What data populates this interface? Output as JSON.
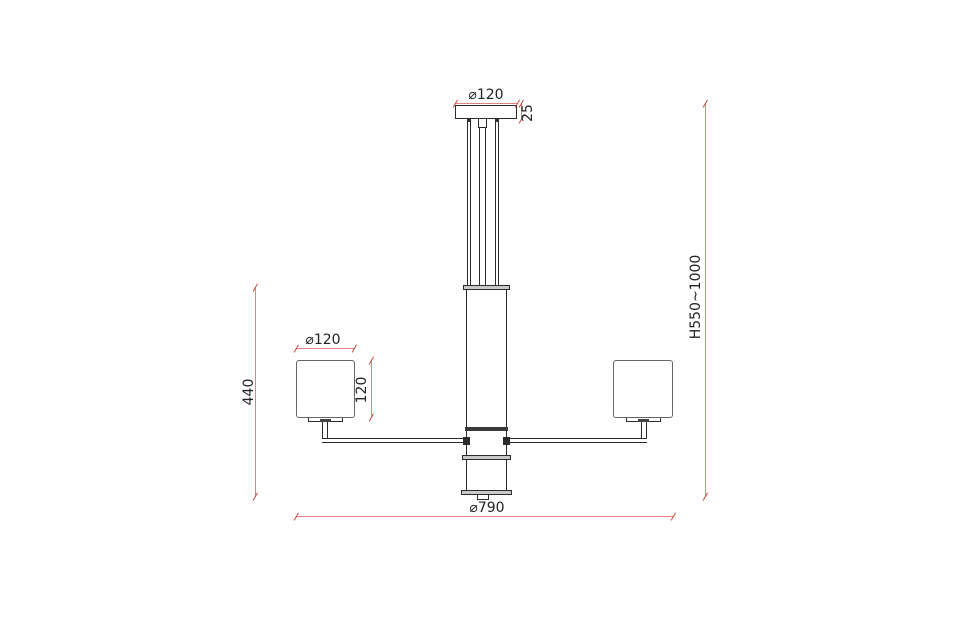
{
  "drawing": {
    "type": "technical dimension drawing",
    "subject": "3-arm pendant ceiling lamp, front elevation"
  },
  "dims": {
    "canopy_dia": "⌀120",
    "canopy_h": "25",
    "shade_dia": "⌀120",
    "shade_h": "120",
    "frame_h": "440",
    "height_range": "H550~1000",
    "overall_dia": "⌀790"
  },
  "colors": {
    "background": "#ffffff",
    "outline": "#2b2b2b",
    "shade_outline": "#666666",
    "gray_fill": "#c9c9c9",
    "dimension_line": "#e2827a",
    "dimension_tick": "#c94a42",
    "text": "#222222"
  }
}
